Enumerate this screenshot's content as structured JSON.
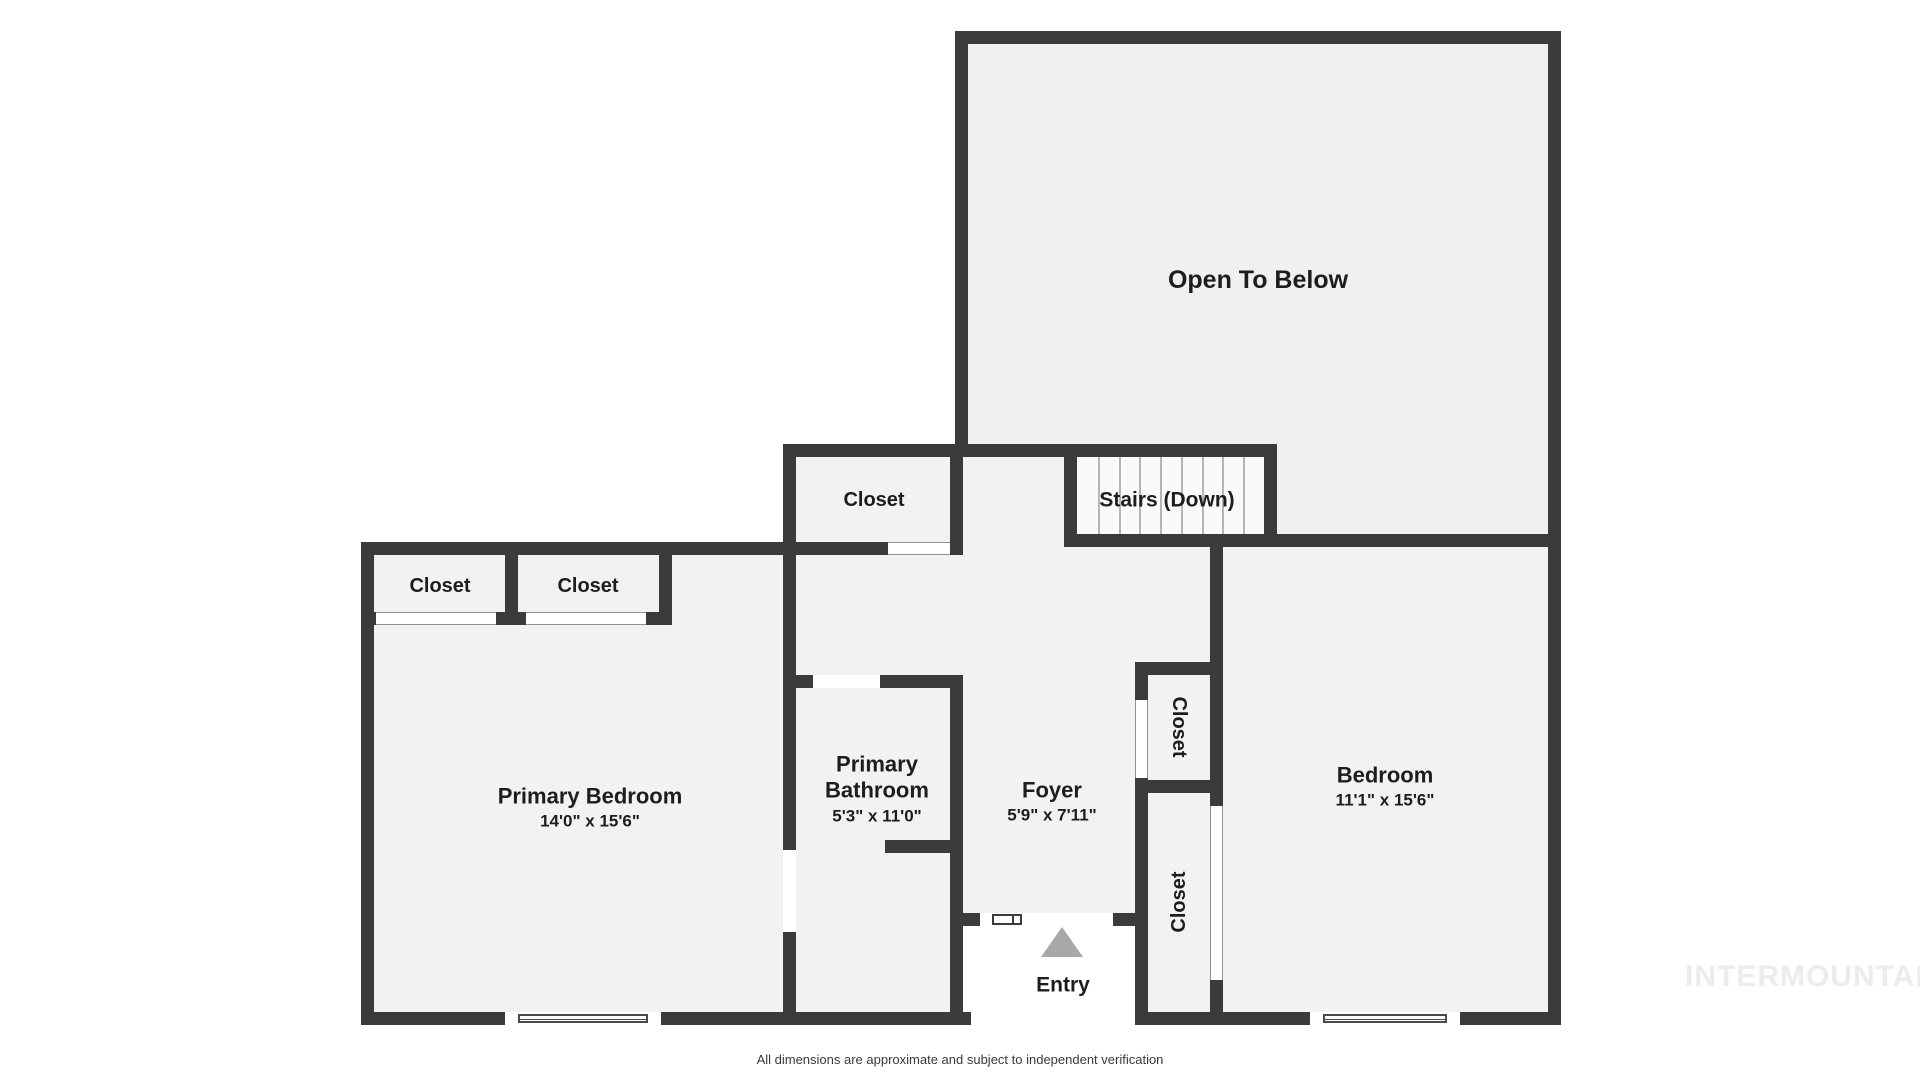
{
  "meta": {
    "type": "floor-plan",
    "floor": "upper level"
  },
  "rooms": {
    "open_to_below": {
      "label": "Open To Below"
    },
    "stairs": {
      "label": "Stairs (Down)"
    },
    "closet_hall": {
      "label": "Closet"
    },
    "closet_primary_1": {
      "label": "Closet"
    },
    "closet_primary_2": {
      "label": "Closet"
    },
    "primary_bedroom": {
      "label": "Primary Bedroom",
      "dimensions": "14'0\" x 15'6\""
    },
    "primary_bathroom": {
      "label": "Primary Bathroom",
      "dimensions": "5'3\" x 11'0\""
    },
    "foyer": {
      "label": "Foyer",
      "dimensions": "5'9\" x 7'11\""
    },
    "closet_foyer": {
      "label": "Closet"
    },
    "closet_bedroom": {
      "label": "Closet"
    },
    "bedroom": {
      "label": "Bedroom",
      "dimensions": "11'1\" x 15'6\""
    },
    "entry": {
      "label": "Entry"
    }
  },
  "footer": {
    "disclaimer": "All dimensions are approximate and subject to independent verification"
  },
  "watermark": {
    "text": "INTERMOUNTAIN"
  },
  "colors": {
    "wall": "#3b3b3b",
    "room_fill": "#f2f2f2",
    "open_to_below_fill": "#f0f0f0",
    "stairs_fill": "#fafafa",
    "tread_line": "#b5b5b5",
    "entry_arrow": "#a8a8a8",
    "watermark": "#ececec",
    "label_text": "#1d1d1d"
  }
}
